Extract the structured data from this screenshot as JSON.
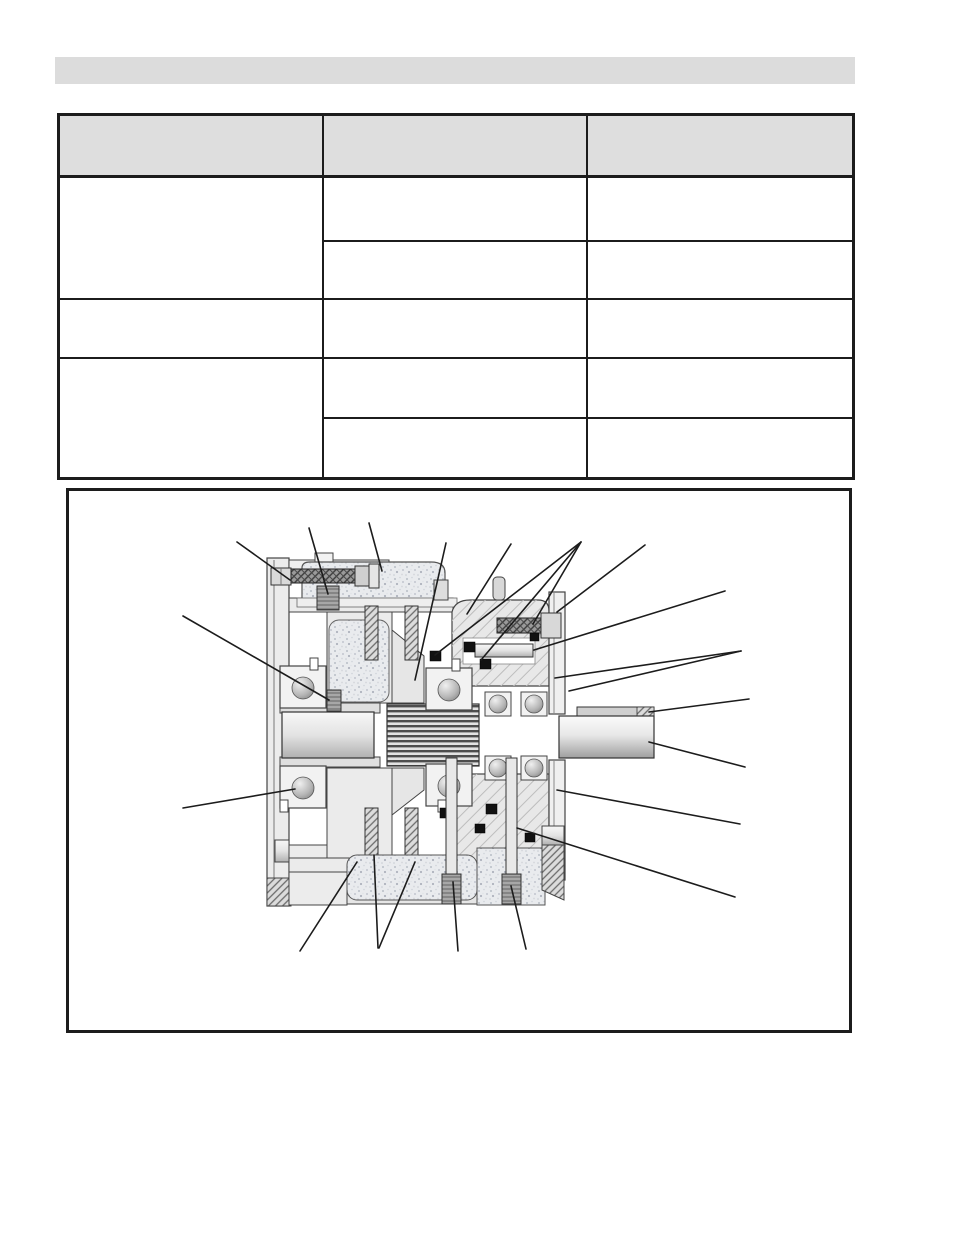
{
  "page": {
    "background": "#ffffff"
  },
  "header_bar": {
    "fill": "#dcdcdc",
    "label": ""
  },
  "table": {
    "border_color": "#1c1c1c",
    "header_fill": "#dedede",
    "header_cells": [
      "",
      "",
      ""
    ],
    "cells": {
      "r1c1": "",
      "r1c2": "",
      "r1c3": "",
      "r2c2": "",
      "r2c3": "",
      "r3c1": "",
      "r3c2": "",
      "r3c3": "",
      "r4c1": "",
      "r4c2": "",
      "r4c3": "",
      "r5c2": "",
      "r5c3": ""
    }
  },
  "figure": {
    "border_color": "#1c1c1c",
    "caption": "",
    "callout_line_count": 23,
    "palette": {
      "casting_stipple_base": "#e9ebee",
      "metal_light": "#ececec",
      "metal_mid": "#cfcfcf",
      "metal_dark": "#8a8a8a",
      "seal_black": "#111111",
      "outline": "#3a3a3a",
      "callout_line": "#1c1c1c"
    }
  }
}
